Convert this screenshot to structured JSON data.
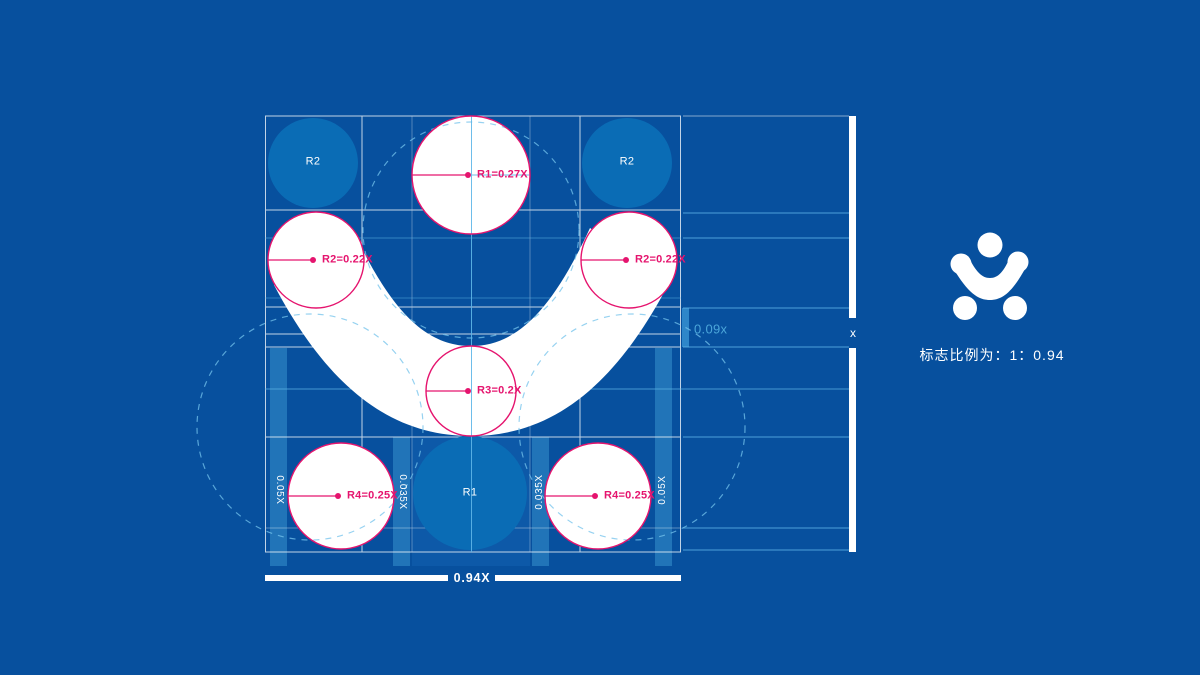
{
  "colors": {
    "background": "#07509e",
    "reference_circle_fill": "#0a6cb5",
    "strip_fill": "#2174b8",
    "gap_marker_fill": "#2e86c9",
    "center_column_fill": "#0d59a8",
    "annotation_magenta": "#e5146e",
    "guide_light_blue": "#5fb6e8",
    "guide_dashed_blue": "#74c3ec",
    "grid_white": "#ffffff",
    "logo_white": "#ffffff"
  },
  "construction": {
    "reference_circles": [
      {
        "id": "top-left",
        "label": "R2"
      },
      {
        "id": "top-right",
        "label": "R2"
      },
      {
        "id": "bottom-center",
        "label": "R1"
      }
    ],
    "radius_annotations": [
      {
        "id": "r1-top",
        "label": "R1=0.27X"
      },
      {
        "id": "r2-left",
        "label": "R2=0.22X"
      },
      {
        "id": "r2-right",
        "label": "R2=0.22X"
      },
      {
        "id": "r3-center",
        "label": "R3=0.2X"
      },
      {
        "id": "r4-bottom-left",
        "label": "R4=0.25X"
      },
      {
        "id": "r4-bottom-right",
        "label": "R4=0.25X"
      }
    ],
    "dimension_labels": {
      "left_outer": "0.05X",
      "left_inner": "0.035X",
      "right_inner": "0.035X",
      "right_outer": "0.05X",
      "vertical_gap": "0.09x",
      "total_height": "x",
      "bottom_width": "0.94X"
    }
  },
  "panel": {
    "caption": "标志比例为：1：0.94"
  }
}
